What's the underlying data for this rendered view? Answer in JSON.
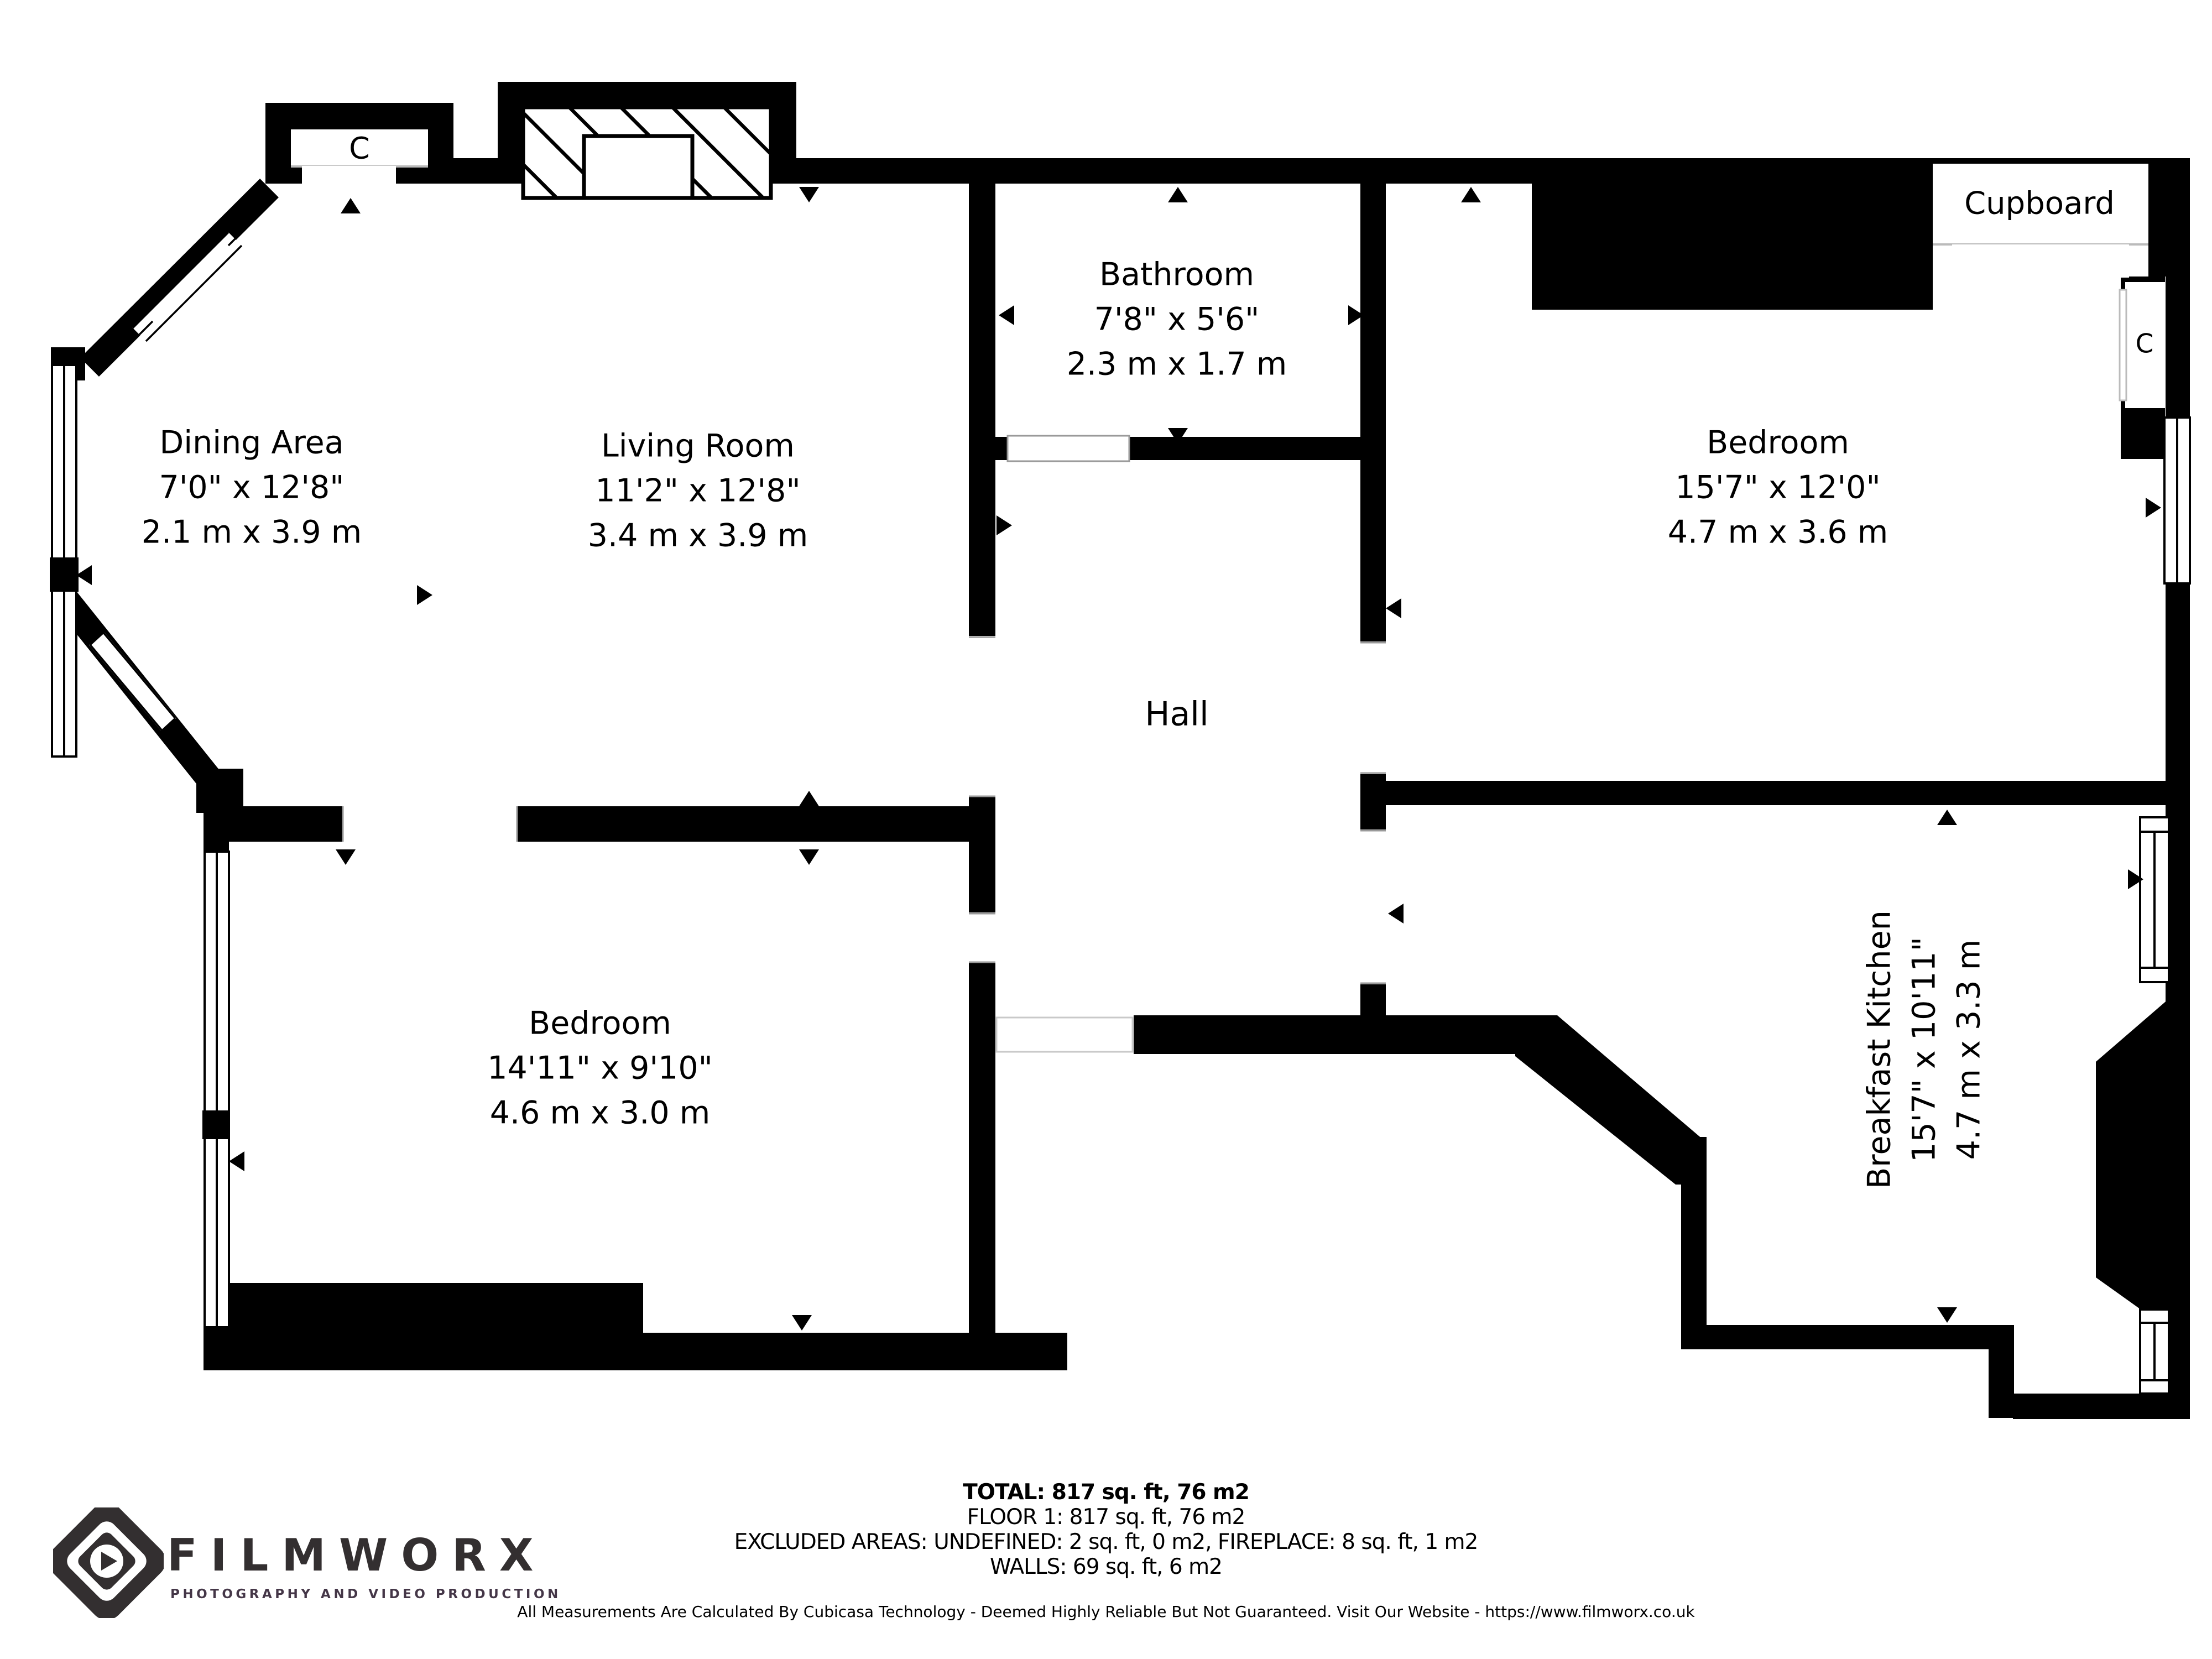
{
  "rooms": {
    "dining": {
      "name": "Dining Area",
      "ft": "7'0\" x 12'8\"",
      "m": "2.1 m x 3.9 m"
    },
    "living": {
      "name": "Living Room",
      "ft": "11'2\" x 12'8\"",
      "m": "3.4 m x 3.9 m"
    },
    "bathroom": {
      "name": "Bathroom",
      "ft": "7'8\" x 5'6\"",
      "m": "2.3 m x 1.7 m"
    },
    "bedroom_right": {
      "name": "Bedroom",
      "ft": "15'7\" x 12'0\"",
      "m": "4.7 m x 3.6 m"
    },
    "hall": {
      "name": "Hall"
    },
    "bedroom_bottom": {
      "name": "Bedroom",
      "ft": "14'11\" x 9'10\"",
      "m": "4.6 m x 3.0 m"
    },
    "kitchen": {
      "name": "Breakfast Kitchen",
      "ft": "15'7\" x 10'11\"",
      "m": "4.7 m x 3.3 m"
    },
    "cupboard_label": "Cupboard",
    "closet_label": "C"
  },
  "summary": {
    "total": "TOTAL: 817 sq. ft, 76 m2",
    "floor": "FLOOR 1: 817 sq. ft, 76 m2",
    "excluded": "EXCLUDED AREAS: UNDEFINED: 2 sq. ft, 0 m2, FIREPLACE: 8 sq. ft, 1 m2",
    "walls": "WALLS: 69 sq. ft, 6 m2",
    "disclaimer": "All Measurements Are Calculated By Cubicasa Technology - Deemed Highly Reliable But Not Guaranteed. Visit Our Website - https://www.filmworx.co.uk"
  },
  "logo": {
    "brand": "FILMWORX",
    "tagline": "PHOTOGRAPHY AND VIDEO PRODUCTION"
  },
  "colors": {
    "wall": "#000000",
    "background": "#ffffff",
    "logo_dark": "#332f30",
    "tagline_purple": "#443647"
  }
}
